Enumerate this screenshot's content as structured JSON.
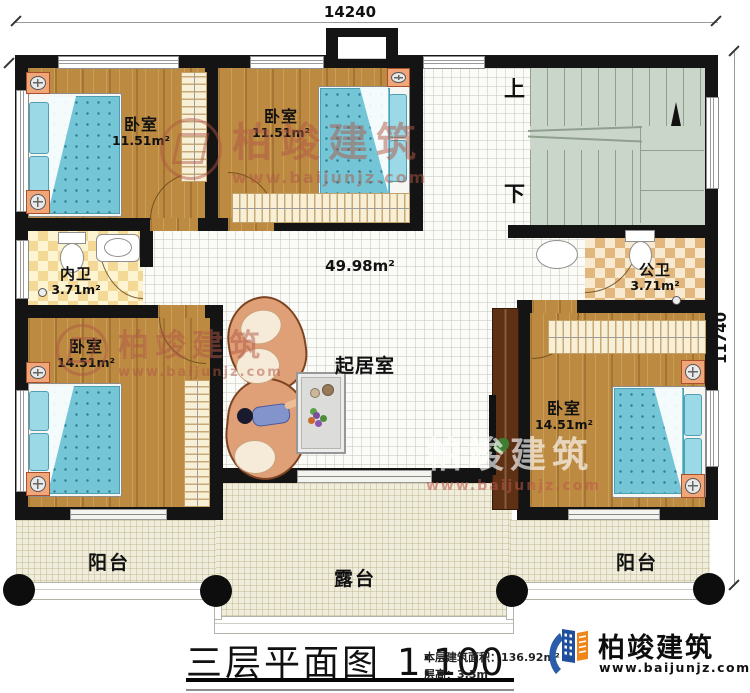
{
  "dim_top": "14240",
  "dim_right": "11740",
  "hall_area": "49.98m²",
  "rooms": {
    "bedroom_tl": {
      "name": "卧室",
      "area": "11.51m²"
    },
    "bedroom_tc": {
      "name": "卧室",
      "area": "11.51m²"
    },
    "bedroom_bl": {
      "name": "卧室",
      "area": "14.51m²"
    },
    "bedroom_br": {
      "name": "卧室",
      "area": "14.51m²"
    },
    "bath_inner": {
      "name": "内卫",
      "area": "3.71m²"
    },
    "bath_public": {
      "name": "公卫",
      "area": "3.71m²"
    },
    "living": {
      "name": "起居室"
    },
    "balcony_left": {
      "name": "阳台"
    },
    "balcony_right": {
      "name": "阳台"
    },
    "terrace": {
      "name": "露台"
    }
  },
  "stairs": {
    "up": "上",
    "down": "下"
  },
  "legend": {
    "title": "三层平面图",
    "scale": "1:100",
    "area_label": "本层建筑面积：",
    "area_value": "136.92m²",
    "height_label": "层高：",
    "height_value": "3.3m"
  },
  "brand": {
    "name": "柏竣建筑",
    "url": "www.baijunjz.com"
  },
  "watermark": {
    "name": "柏竣建筑",
    "url": "www.baijunjz.com"
  },
  "colors": {
    "wall": "#141414",
    "wood_floor": "#bc8a41",
    "stair": "#cbd6ca",
    "terrace": "#f0eddc",
    "water_blue": "#74c6d7",
    "brand_blue": "#2a5caa",
    "brand_orange": "#f08519",
    "watermark_red": "#af5546"
  }
}
